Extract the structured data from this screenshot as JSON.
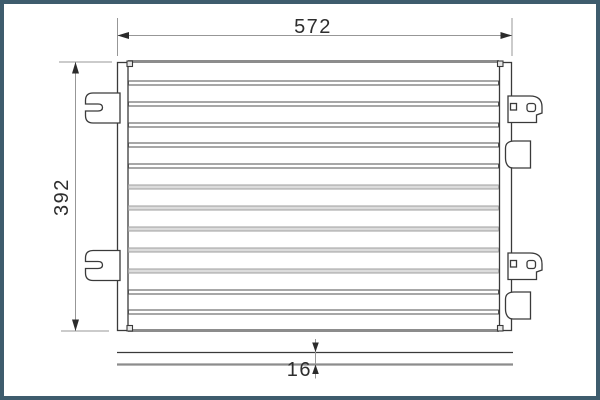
{
  "drawing": {
    "kind": "technical-dimension-drawing",
    "views": {
      "front_view": "condenser core with side tanks, mounting brackets and clips",
      "profile_view": "thin bottom strip showing part depth"
    },
    "dimensions": {
      "width_label": "572",
      "height_label": "392",
      "depth_label": "16"
    },
    "front_view": {
      "core": {
        "x": 128.5,
        "width": 370,
        "row_height": 4,
        "tube_rows": [
          {
            "y": 81,
            "shade": "dark"
          },
          {
            "y": 102,
            "shade": "dark"
          },
          {
            "y": 123,
            "shade": "dark"
          },
          {
            "y": 143,
            "shade": "dark"
          },
          {
            "y": 164,
            "shade": "dark"
          },
          {
            "y": 185,
            "shade": "light"
          },
          {
            "y": 206,
            "shade": "light"
          },
          {
            "y": 227,
            "shade": "light"
          },
          {
            "y": 248,
            "shade": "light"
          },
          {
            "y": 269,
            "shade": "light"
          },
          {
            "y": 290,
            "shade": "dark"
          },
          {
            "y": 310,
            "shade": "dark"
          }
        ]
      }
    }
  },
  "colors": {
    "frame": "#3e5c6d",
    "background": "#ffffff",
    "outline": "#3a3a3a",
    "edge": "#8c8c8c",
    "tube_dark": "#4f4f4f",
    "tube_light": "#9e9e9e",
    "dim_line": "#979797",
    "arrow": "#2b2b2b",
    "text": "#2e2e2e"
  }
}
